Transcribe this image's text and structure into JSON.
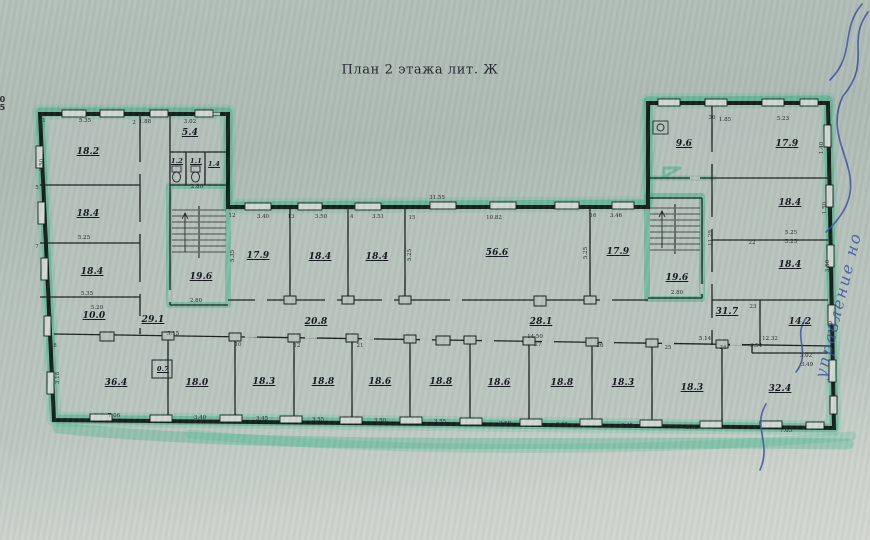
{
  "title": "План 2 этажа лит. Ж",
  "margin_note": {
    "line1": "20",
    "line2": "45"
  },
  "handwriting": {
    "fragment": "управление но"
  },
  "colors": {
    "paper": "#b4c1ba",
    "wall_line": "#181d1b",
    "highlighter_green": "#2eae80",
    "pen_ink_blue": "#3c50a2"
  },
  "room_labels": [
    {
      "t": "18.2",
      "x": 88,
      "y": 152
    },
    {
      "t": "18.4",
      "x": 88,
      "y": 214
    },
    {
      "t": "18.4",
      "x": 92,
      "y": 272
    },
    {
      "t": "10.0",
      "x": 94,
      "y": 316
    },
    {
      "t": "29.1",
      "x": 153,
      "y": 320
    },
    {
      "t": "19.6",
      "x": 201,
      "y": 277
    },
    {
      "t": "5.4",
      "x": 190,
      "y": 133
    },
    {
      "t": "1.2",
      "x": 177,
      "y": 161,
      "small": true
    },
    {
      "t": "1.1",
      "x": 196,
      "y": 161,
      "small": true
    },
    {
      "t": "1.4",
      "x": 214,
      "y": 164,
      "small": true
    },
    {
      "t": "0.7",
      "x": 163,
      "y": 369,
      "small": true
    },
    {
      "t": "17.9",
      "x": 258,
      "y": 256
    },
    {
      "t": "18.4",
      "x": 320,
      "y": 257
    },
    {
      "t": "18.4",
      "x": 377,
      "y": 257
    },
    {
      "t": "56.6",
      "x": 497,
      "y": 253
    },
    {
      "t": "17.9",
      "x": 618,
      "y": 252
    },
    {
      "t": "20.8",
      "x": 316,
      "y": 322
    },
    {
      "t": "28.1",
      "x": 541,
      "y": 322
    },
    {
      "t": "31.7",
      "x": 727,
      "y": 312
    },
    {
      "t": "9.6",
      "x": 684,
      "y": 144
    },
    {
      "t": "19.6",
      "x": 677,
      "y": 278
    },
    {
      "t": "17.9",
      "x": 787,
      "y": 144
    },
    {
      "t": "18.4",
      "x": 790,
      "y": 203
    },
    {
      "t": "18.4",
      "x": 790,
      "y": 265
    },
    {
      "t": "14.2",
      "x": 800,
      "y": 322
    },
    {
      "t": "32.4",
      "x": 780,
      "y": 389
    },
    {
      "t": "36.4",
      "x": 116,
      "y": 383
    },
    {
      "t": "18.0",
      "x": 197,
      "y": 383
    },
    {
      "t": "18.3",
      "x": 264,
      "y": 382
    },
    {
      "t": "18.8",
      "x": 323,
      "y": 382
    },
    {
      "t": "18.6",
      "x": 380,
      "y": 382
    },
    {
      "t": "18.8",
      "x": 441,
      "y": 382
    },
    {
      "t": "18.6",
      "x": 499,
      "y": 383
    },
    {
      "t": "18.8",
      "x": 562,
      "y": 383
    },
    {
      "t": "18.3",
      "x": 623,
      "y": 383
    },
    {
      "t": "18.3",
      "x": 692,
      "y": 388
    }
  ],
  "dim_labels": [
    {
      "t": "5.35",
      "x": 85,
      "y": 121
    },
    {
      "t": "1.88",
      "x": 145,
      "y": 122
    },
    {
      "t": "3.02",
      "x": 190,
      "y": 122
    },
    {
      "t": "5.25",
      "x": 84,
      "y": 238
    },
    {
      "t": "5.35",
      "x": 87,
      "y": 294
    },
    {
      "t": "5.20",
      "x": 97,
      "y": 308
    },
    {
      "t": "2.80",
      "x": 197,
      "y": 187
    },
    {
      "t": "2.80",
      "x": 196,
      "y": 301
    },
    {
      "t": "5.15",
      "x": 173,
      "y": 334
    },
    {
      "t": "7.06",
      "x": 114,
      "y": 416
    },
    {
      "t": "3.40",
      "x": 200,
      "y": 418
    },
    {
      "t": "3.45",
      "x": 262,
      "y": 419
    },
    {
      "t": "3.55",
      "x": 318,
      "y": 420
    },
    {
      "t": "3.50",
      "x": 380,
      "y": 421
    },
    {
      "t": "3.55",
      "x": 440,
      "y": 422
    },
    {
      "t": "3.50",
      "x": 505,
      "y": 424
    },
    {
      "t": "3.55",
      "x": 562,
      "y": 425
    },
    {
      "t": "3.45",
      "x": 627,
      "y": 426
    },
    {
      "t": "3.45",
      "x": 692,
      "y": 428
    },
    {
      "t": "7.05",
      "x": 786,
      "y": 431
    },
    {
      "t": "14.50",
      "x": 535,
      "y": 337
    },
    {
      "t": "31.55",
      "x": 437,
      "y": 198
    },
    {
      "t": "3.40",
      "x": 263,
      "y": 217
    },
    {
      "t": "3.50",
      "x": 321,
      "y": 217
    },
    {
      "t": "3.51",
      "x": 378,
      "y": 217
    },
    {
      "t": "10.82",
      "x": 494,
      "y": 218
    },
    {
      "t": "3.46",
      "x": 616,
      "y": 216
    },
    {
      "t": "5.23",
      "x": 783,
      "y": 119
    },
    {
      "t": "1.85",
      "x": 725,
      "y": 120
    },
    {
      "t": "5.25",
      "x": 791,
      "y": 233
    },
    {
      "t": "5.25",
      "x": 791,
      "y": 242
    },
    {
      "t": "5.14",
      "x": 705,
      "y": 339
    },
    {
      "t": "12.32",
      "x": 770,
      "y": 339
    },
    {
      "t": "3.54",
      "x": 756,
      "y": 346
    },
    {
      "t": "3.02",
      "x": 806,
      "y": 356
    },
    {
      "t": "3.49",
      "x": 807,
      "y": 365
    },
    {
      "t": "2.80",
      "x": 677,
      "y": 293
    },
    {
      "t": "1.40",
      "x": 822,
      "y": 148,
      "rot": true
    },
    {
      "t": "11.29",
      "x": 711,
      "y": 238,
      "rot": true
    },
    {
      "t": "3.18",
      "x": 58,
      "y": 378,
      "rot": true
    },
    {
      "t": "5.35",
      "x": 233,
      "y": 256,
      "rot": true
    },
    {
      "t": "5.25",
      "x": 410,
      "y": 255,
      "rot": true
    },
    {
      "t": "5.25",
      "x": 586,
      "y": 253,
      "rot": true
    },
    {
      "t": "1.50",
      "x": 825,
      "y": 208,
      "rot": true
    },
    {
      "t": "3.50",
      "x": 828,
      "y": 266,
      "rot": true
    },
    {
      "t": "3.50",
      "x": 831,
      "y": 327,
      "rot": true
    },
    {
      "t": "3.50",
      "x": 42,
      "y": 165,
      "rot": true
    }
  ],
  "tag_labels": [
    {
      "t": "12",
      "x": 232,
      "y": 216
    },
    {
      "t": "13",
      "x": 291,
      "y": 217
    },
    {
      "t": "14",
      "x": 350,
      "y": 217
    },
    {
      "t": "15",
      "x": 412,
      "y": 218
    },
    {
      "t": "16",
      "x": 593,
      "y": 216
    },
    {
      "t": "10",
      "x": 238,
      "y": 345
    },
    {
      "t": "12",
      "x": 297,
      "y": 346
    },
    {
      "t": "21",
      "x": 360,
      "y": 346
    },
    {
      "t": "27",
      "x": 538,
      "y": 345
    },
    {
      "t": "26",
      "x": 600,
      "y": 346
    },
    {
      "t": "25",
      "x": 668,
      "y": 348
    },
    {
      "t": "24",
      "x": 723,
      "y": 348
    },
    {
      "t": "23",
      "x": 753,
      "y": 307
    },
    {
      "t": "22",
      "x": 752,
      "y": 243
    },
    {
      "t": "30",
      "x": 712,
      "y": 118
    },
    {
      "t": "1",
      "x": 44,
      "y": 121
    },
    {
      "t": "2",
      "x": 134,
      "y": 123
    },
    {
      "t": "5",
      "x": 37,
      "y": 188
    },
    {
      "t": "7",
      "x": 37,
      "y": 247
    },
    {
      "t": "8",
      "x": 55,
      "y": 346
    }
  ]
}
